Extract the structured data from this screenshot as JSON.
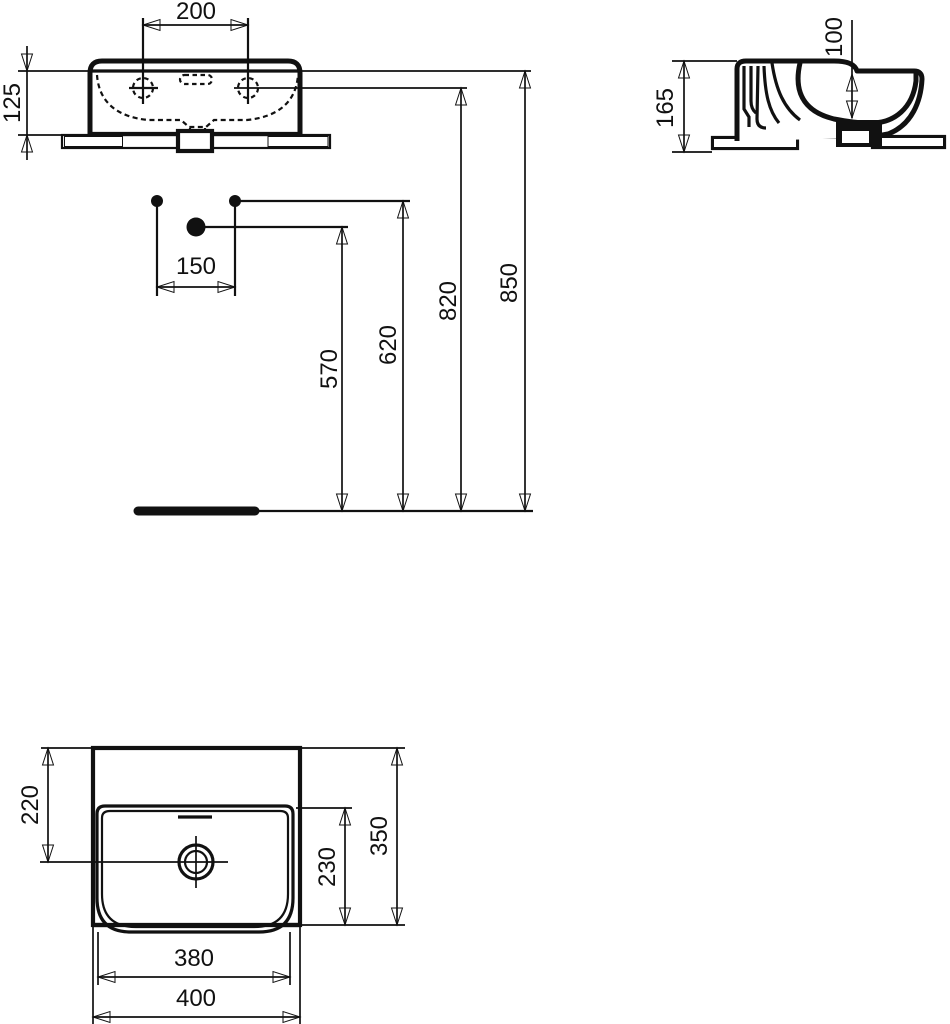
{
  "drawing": {
    "kind": "sanitary-ware dimension drawing",
    "views": [
      "front-view",
      "installation-dimensions",
      "side-view",
      "plan-view"
    ]
  },
  "colors": {
    "ink": "#111111",
    "paper": "#ffffff"
  },
  "dimensions": {
    "front_view": {
      "fixing_hole_spacing": "200",
      "basin_edge_height": "125"
    },
    "installation": {
      "fixing_hole_offset": "150",
      "waste_outlet_height": "570",
      "supply_height": "620",
      "fixing_hole_height": "820",
      "rim_height": "850"
    },
    "side_view": {
      "basin_height": "165",
      "bowl_depth": "100"
    },
    "plan_view": {
      "drain_setback": "220",
      "bowl_front_to_back": "230",
      "overall_depth": "350",
      "inner_width": "380",
      "overall_width": "400"
    }
  },
  "chart_data": {
    "type": "table",
    "title": "Washbasin dimensions (mm)",
    "values": [
      200,
      125,
      150,
      570,
      620,
      820,
      850,
      165,
      100,
      220,
      230,
      350,
      380,
      400
    ]
  }
}
